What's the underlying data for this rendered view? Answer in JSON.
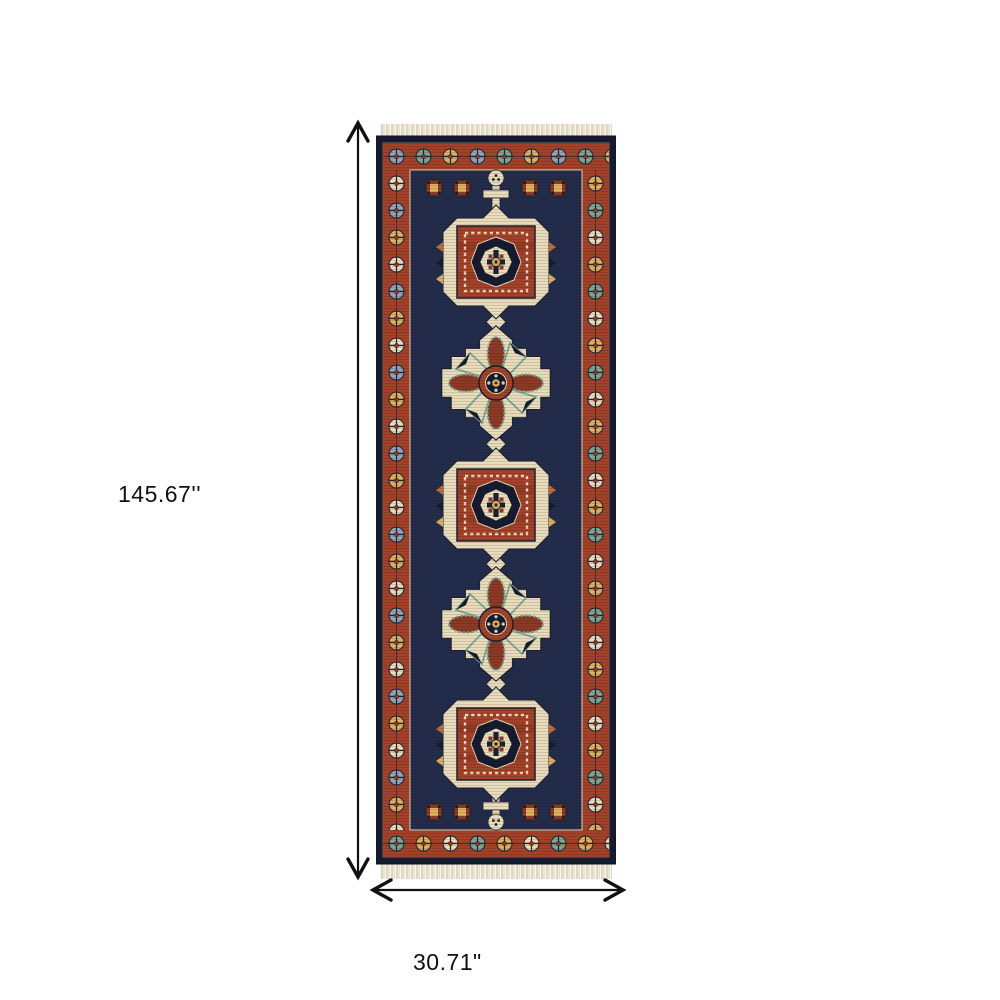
{
  "diagram": {
    "title": "rug-dimension-diagram",
    "height_label": "145.67''",
    "width_label": "30.71\""
  },
  "icons": {
    "height_arrow": "vertical-double-headed-arrow",
    "width_arrow": "horizontal-double-headed-arrow"
  },
  "colors": {
    "background": "#ffffff",
    "line": "#111111",
    "navy": "#232c4a",
    "navy_dark": "#161b2f",
    "red": "#a34129",
    "rust": "#8c3a24",
    "cream": "#e9dcba",
    "fringe": "#eae2cf",
    "fringe_shadow": "#cfc3a8",
    "gold": "#ddb25c",
    "teal": "#7ca794",
    "blue": "#8fa6bb",
    "orange": "#c06c38"
  }
}
